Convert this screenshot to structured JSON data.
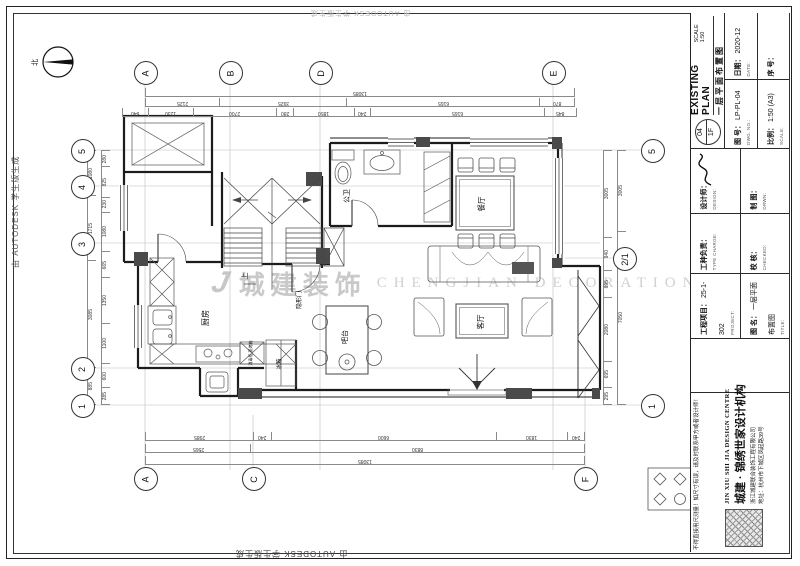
{
  "sheet": {
    "autodesk_note": "由 AUTODESK 学生版生成"
  },
  "watermark": {
    "logo_mark": "J",
    "brand_cn": "城建装饰",
    "brand_en": "CHENGJIAN DECORATION"
  },
  "north_label": "北",
  "plan": {
    "rooms": {
      "kitchen": "厨房",
      "bath": "公卫",
      "dining": "餐厅",
      "living": "客厅",
      "bar": "吧台",
      "fridge": "冰箱",
      "hidden_door": "隐形门",
      "up": "上",
      "cabinet": "消毒柜 蒸烤箱"
    }
  },
  "grid": {
    "bubbles": [
      {
        "x": 145,
        "y": 72,
        "label": "A"
      },
      {
        "x": 230,
        "y": 72,
        "label": "B"
      },
      {
        "x": 320,
        "y": 72,
        "label": "D"
      },
      {
        "x": 553,
        "y": 72,
        "label": "E"
      },
      {
        "x": 82,
        "y": 150,
        "label": "5"
      },
      {
        "x": 82,
        "y": 186,
        "label": "4"
      },
      {
        "x": 82,
        "y": 243,
        "label": "3"
      },
      {
        "x": 82,
        "y": 368,
        "label": "2"
      },
      {
        "x": 82,
        "y": 405,
        "label": "1"
      },
      {
        "x": 652,
        "y": 150,
        "label": "5"
      },
      {
        "x": 624,
        "y": 258,
        "label": "2/1"
      },
      {
        "x": 652,
        "y": 405,
        "label": "1"
      },
      {
        "x": 145,
        "y": 478,
        "label": "A"
      },
      {
        "x": 253,
        "y": 478,
        "label": "C"
      },
      {
        "x": 585,
        "y": 478,
        "label": "F"
      }
    ]
  },
  "dimensions": {
    "chains": [
      {
        "x": 145,
        "y": 88,
        "len": 430,
        "dir": "h",
        "values": [
          "13085"
        ]
      },
      {
        "x": 145,
        "y": 98,
        "len": 430,
        "dir": "h",
        "values": [
          "2125",
          "3925",
          "6165",
          "870"
        ]
      },
      {
        "x": 122,
        "y": 108,
        "len": 455,
        "dir": "h",
        "values": [
          "640",
          "1230",
          "2700",
          "280",
          "1850",
          "240",
          "6165",
          "845"
        ]
      },
      {
        "x": 96,
        "y": 150,
        "len": 255,
        "dir": "v",
        "values": [
          "1080",
          "1715",
          "3085",
          "885"
        ]
      },
      {
        "x": 110,
        "y": 150,
        "len": 255,
        "dir": "v",
        "values": [
          "280",
          "825",
          "230",
          "1080",
          "665",
          "1350",
          "1100",
          "600",
          "285"
        ]
      },
      {
        "x": 612,
        "y": 150,
        "len": 255,
        "dir": "v",
        "values": [
          "3005",
          "940",
          "695",
          "2080",
          "695",
          "295"
        ]
      },
      {
        "x": 626,
        "y": 150,
        "len": 255,
        "dir": "v",
        "values": [
          "3005",
          "7050"
        ]
      },
      {
        "x": 145,
        "y": 432,
        "len": 440,
        "dir": "h",
        "values": [
          "2985",
          "240",
          "6600",
          "1830",
          "240"
        ]
      },
      {
        "x": 145,
        "y": 444,
        "len": 440,
        "dir": "h",
        "values": [
          "2565",
          "8830"
        ]
      },
      {
        "x": 145,
        "y": 456,
        "len": 440,
        "dir": "h",
        "values": [
          "13085"
        ]
      }
    ]
  },
  "title_block": {
    "sheet_no_top": "04",
    "sheet_no_bottom": "1F",
    "title_cn": "一层平面布置图",
    "title_en": "EXISTING PLAN",
    "scale_note": "SCALE 1:50",
    "dwg_label": "图 号：",
    "dwg_sub": "DWG. NO.:",
    "dwg_value": "LP-PL-04",
    "date_label": "日期：",
    "date_sub": "DATE:",
    "date_value": "2020-12",
    "scale_label": "比例：",
    "scale_sub": "SCALE:",
    "scale_value": "1:50 (A3)",
    "serial_label": "序 号：",
    "designer_label": "设计师：",
    "designer_sub": "DESIGN:",
    "draft_label": "制 图：",
    "draft_sub": "DRWN:",
    "type_label": "工种负责：",
    "type_sub": "TYPE CHARGE:",
    "check_label": "校 核：",
    "check_sub": "CHECKED:",
    "project_label": "工程项目：",
    "project_sub": "PROJECT:",
    "project_value": "25-1-302",
    "name_label": "图 名：",
    "name_sub": "TITLE:",
    "name_value": "一层平面布置图",
    "warning": "不得直接用尺测量！如尺寸有误，请及时联系甲方或者设计师！",
    "company_en": "JIN XIU SHI JIA DESIGN CENTRE",
    "company_cn": "城建 · 锦绣世家设计机构",
    "company_firm": "浙江城建联合装饰工程有限公司",
    "company_addr": "地址：杭州市下城区凤起路39号"
  }
}
